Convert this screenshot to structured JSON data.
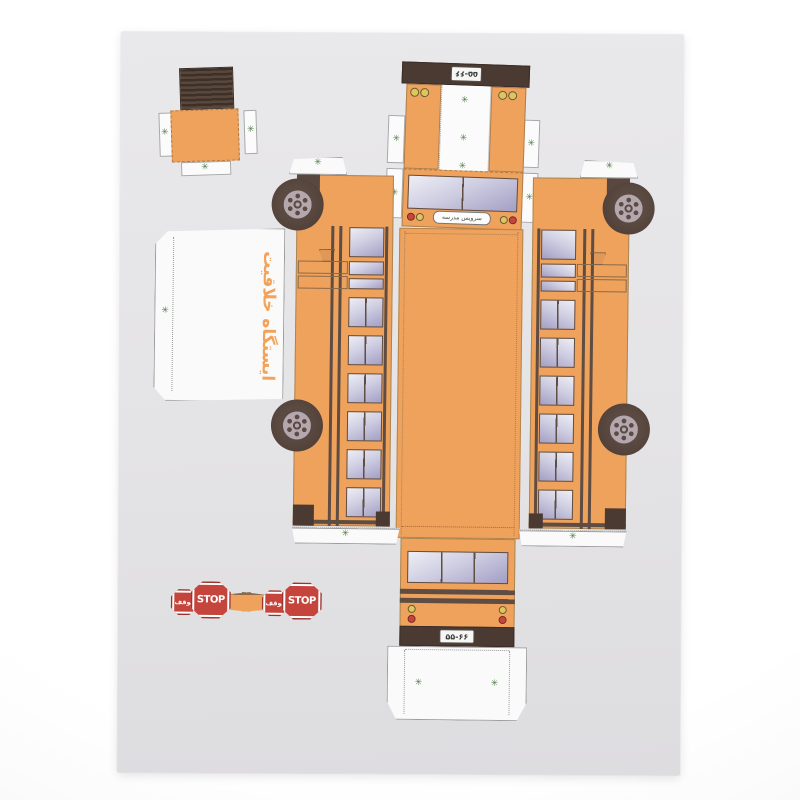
{
  "sheet": {
    "color": "#e6e5e8"
  },
  "marks": {
    "glue": "✳"
  },
  "brand": {
    "text": "ایستگاه خلاقیت",
    "color": "#f2a359"
  },
  "bus": {
    "license_plate": "۵۵-۶۶",
    "front_sign": "سرویس مدرسه",
    "body_color": "#efa25c",
    "trim_color": "#4a3a32",
    "glass_color_top": "#eeeef6",
    "glass_color_bottom": "#a29fc4",
    "marker_light_color": "#dcc75f",
    "tail_light_color": "#c4473e"
  },
  "stop_sign": {
    "text_en": "STOP",
    "text_fa": "توقف",
    "color": "#c5443c"
  }
}
